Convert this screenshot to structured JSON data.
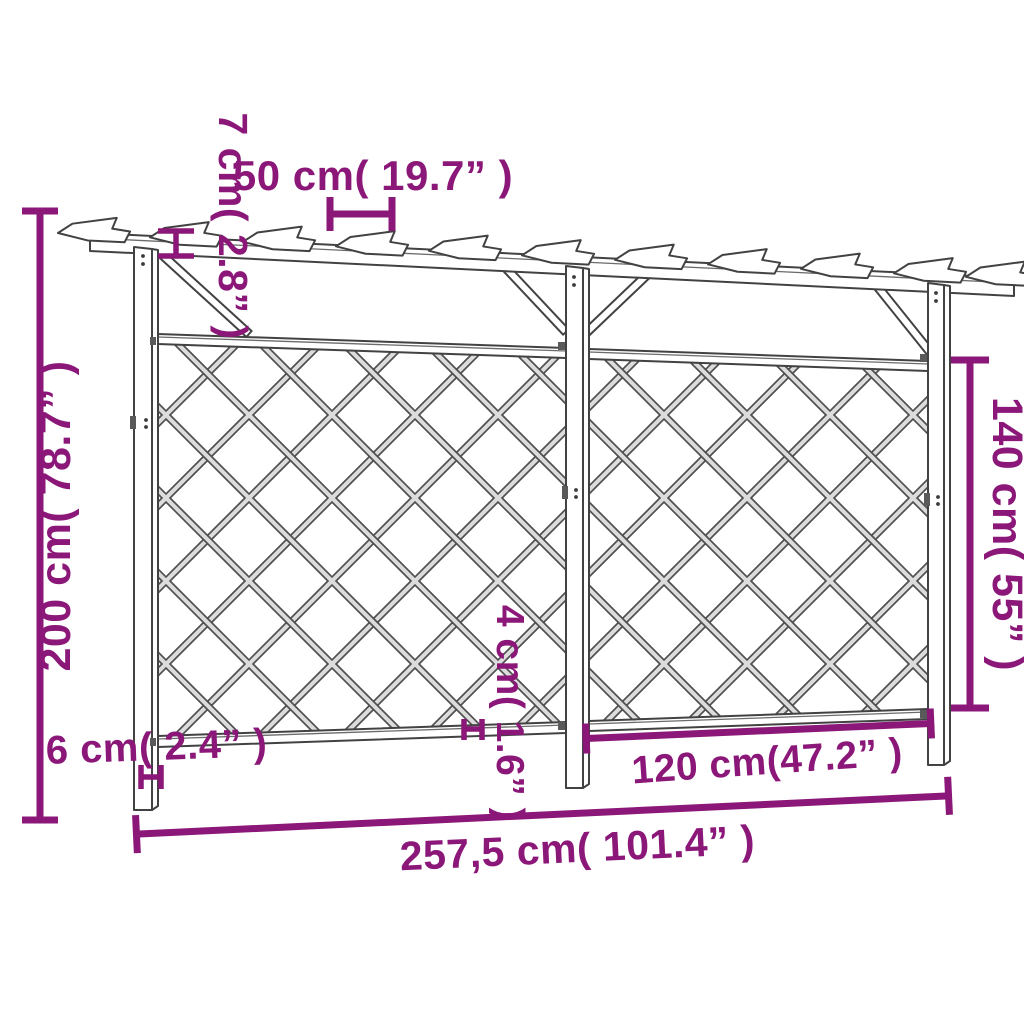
{
  "diagram": {
    "kind": "pergola-trellis-dimension-drawing",
    "accent_color": "#8b1779",
    "outline_color": "#424242",
    "background": "#ffffff"
  },
  "labels": {
    "beam_height": "7 cm( 2.8” )",
    "rafter_spacing": "50 cm( 19.7” )",
    "total_height": "200 cm( 78.7” )",
    "trellis_height": "140 cm( 55” )",
    "post_width": "6 cm( 2.4” )",
    "rail_width": "4 cm( 1.6” )",
    "panel_width": "120 cm(47.2” )",
    "total_width": "257,5 cm( 101.4” )"
  }
}
